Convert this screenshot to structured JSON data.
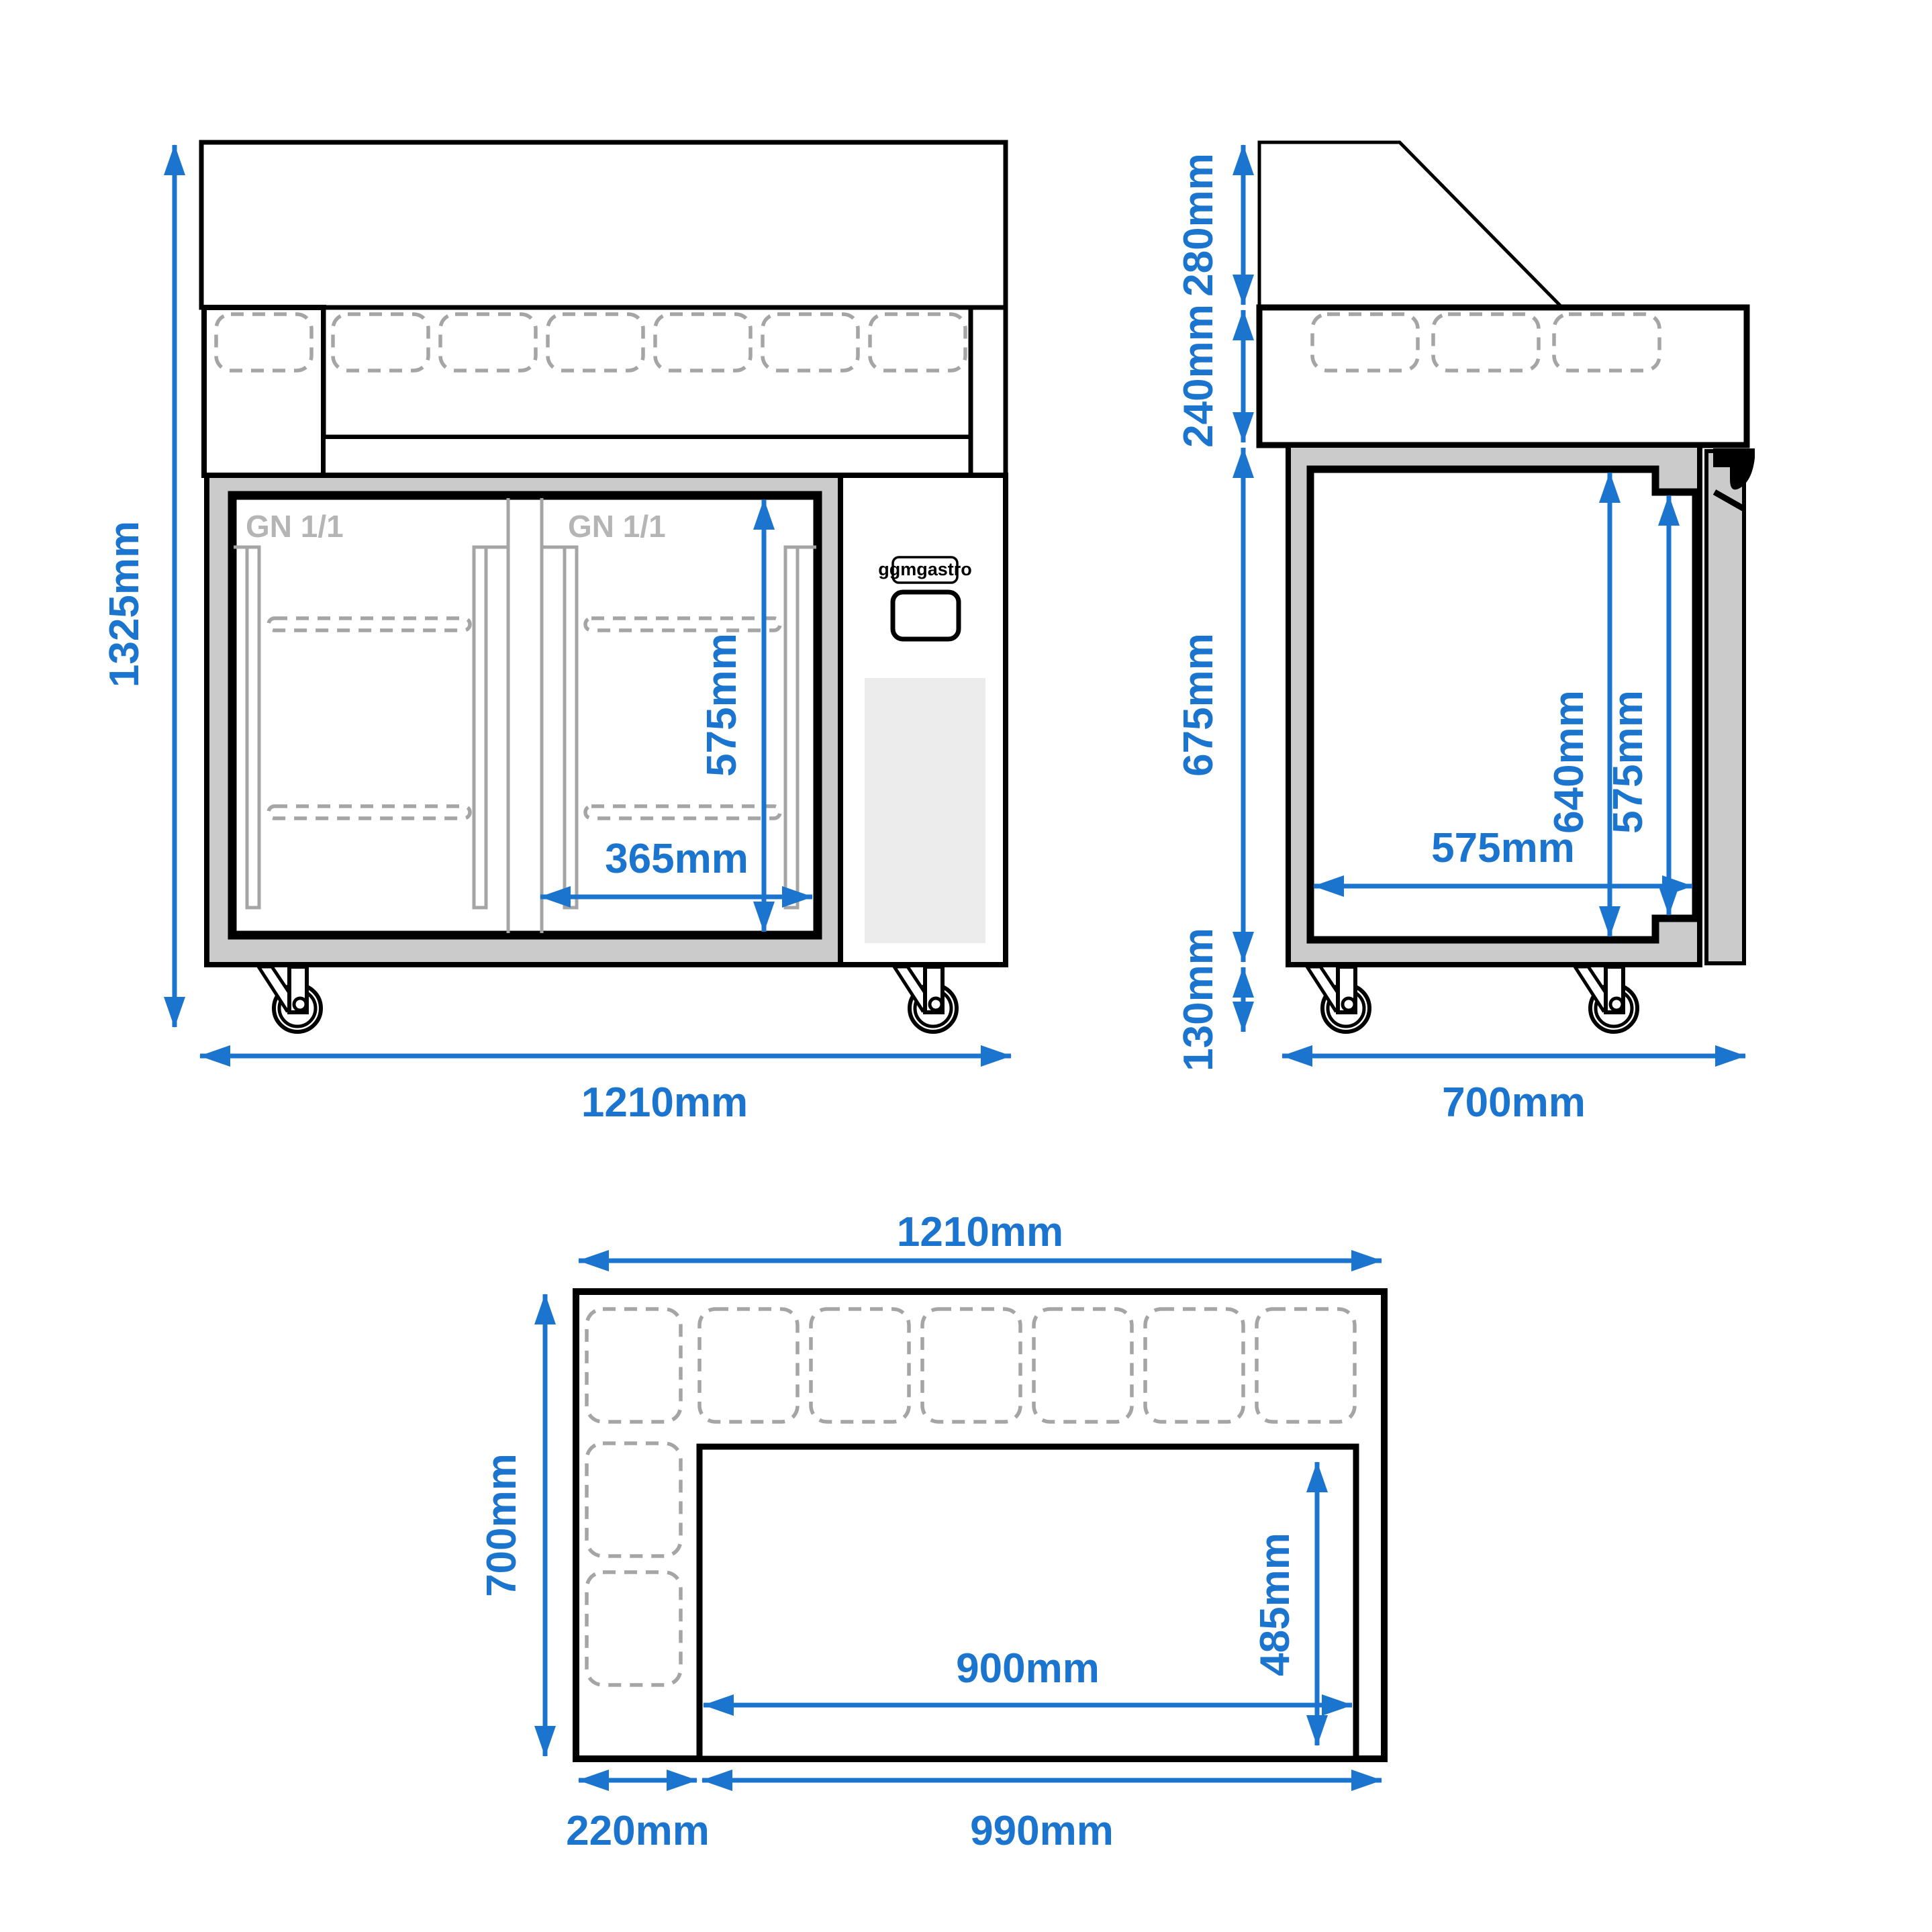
{
  "drawing": {
    "brand": "ggmgastro",
    "front": {
      "overall_height": "1325mm",
      "overall_width": "1210mm",
      "door_opening_height": "575mm",
      "door_opening_width": "365mm",
      "left_door_pan_label": "GN 1/1",
      "right_door_pan_label": "GN 1/1"
    },
    "side": {
      "glass_section_height": "280mm",
      "pan_section_height": "240mm",
      "body_height": "675mm",
      "caster_height": "130mm",
      "interior_height": "640mm",
      "door_height": "575mm",
      "interior_depth": "575mm",
      "overall_depth": "700mm"
    },
    "top": {
      "overall_width": "1210mm",
      "overall_depth": "700mm",
      "compressor_section_width": "220mm",
      "worktop_width": "990mm",
      "worktop_cutout_width": "900mm",
      "worktop_cutout_depth": "485mm"
    },
    "colors": {
      "dimension_blue": "#1b74cd",
      "body_gray": "#cbcbcb",
      "detail_gray": "#a5a5a5",
      "vent_gray": "#ececec",
      "line_black": "#000000"
    }
  }
}
